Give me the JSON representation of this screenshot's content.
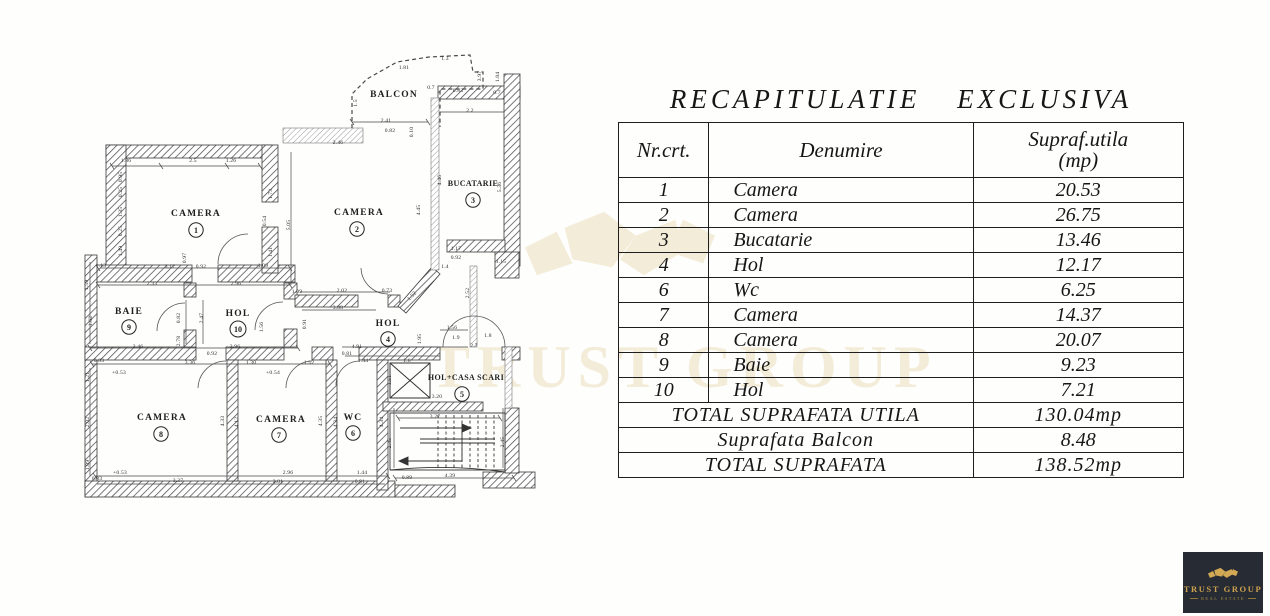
{
  "watermark": {
    "text": "TRUST GROUP",
    "color": "#f3ecd8"
  },
  "logo": {
    "name": "TRUST GROUP",
    "subtitle": "REAL ESTATE",
    "bg": "#272b34",
    "gold": "#cba14f"
  },
  "table": {
    "title": "RECAPITULATIE EXCLUSIVA",
    "columns": {
      "nr": "Nr.crt.",
      "den": "Denumire",
      "sup": "Supraf.utila",
      "sup_unit": "(mp)"
    },
    "rows": [
      [
        "1",
        "Camera",
        "20.53"
      ],
      [
        "2",
        "Camera",
        "26.75"
      ],
      [
        "3",
        "Bucatarie",
        "13.46"
      ],
      [
        "4",
        "Hol",
        "12.17"
      ],
      [
        "6",
        "Wc",
        "6.25"
      ],
      [
        "7",
        "Camera",
        "14.37"
      ],
      [
        "8",
        "Camera",
        "20.07"
      ],
      [
        "9",
        "Baie",
        "9.23"
      ],
      [
        "10",
        "Hol",
        "7.21"
      ]
    ],
    "totals": [
      {
        "label": "TOTAL SUPRAFATA  UTILA",
        "value": "130.04mp"
      },
      {
        "label": "Suprafata Balcon",
        "value": "8.48"
      },
      {
        "label": "TOTAL SUPRAFATA",
        "value": "138.52mp"
      }
    ]
  },
  "floorplan": {
    "rooms": [
      {
        "label": "CAMERA",
        "num": "1",
        "lx": 196,
        "ly": 216,
        "nx": 196,
        "ny": 230
      },
      {
        "label": "CAMERA",
        "num": "2",
        "lx": 359,
        "ly": 215,
        "nx": 357,
        "ny": 229
      },
      {
        "label": "BUCATARIE",
        "num": "3",
        "lx": 473,
        "ly": 186,
        "nx": 473,
        "ny": 200,
        "small": true
      },
      {
        "label": "BALCON",
        "lx": 394,
        "ly": 97
      },
      {
        "label": "BAIE",
        "num": "9",
        "lx": 129,
        "ly": 314,
        "nx": 129,
        "ny": 327
      },
      {
        "label": "HOL",
        "num": "10",
        "lx": 238,
        "ly": 316,
        "nx": 238,
        "ny": 329
      },
      {
        "label": "HOL",
        "num": "4",
        "lx": 388,
        "ly": 326,
        "nx": 388,
        "ny": 339
      },
      {
        "label": "CAMERA",
        "num": "8",
        "lx": 162,
        "ly": 420,
        "nx": 161,
        "ny": 434
      },
      {
        "label": "CAMERA",
        "num": "7",
        "lx": 281,
        "ly": 422,
        "nx": 279,
        "ny": 435
      },
      {
        "label": "WC",
        "num": "6",
        "lx": 353,
        "ly": 420,
        "nx": 353,
        "ny": 433
      },
      {
        "label": "HOL+CASA SCARI",
        "num": "5",
        "lx": 466,
        "ly": 380,
        "nx": 462,
        "ny": 394,
        "small": true
      }
    ],
    "dims": [
      [
        "1.86",
        126,
        162
      ],
      [
        "2.5",
        193,
        162
      ],
      [
        "1.26",
        231,
        162
      ],
      [
        "0.95",
        122,
        177,
        1
      ],
      [
        "0.25",
        122,
        192,
        1
      ],
      [
        "1.35",
        122,
        212,
        1
      ],
      [
        "0.25",
        122,
        231,
        1
      ],
      [
        "1.49",
        122,
        251,
        1
      ],
      [
        "0.97",
        186,
        258,
        1
      ],
      [
        "3.17",
        170,
        268
      ],
      [
        "0.92",
        201,
        268
      ],
      [
        "1.09",
        263,
        267
      ],
      [
        "1.13",
        101,
        267
      ],
      [
        "2.33",
        152,
        285
      ],
      [
        "2.96",
        236,
        285
      ],
      [
        "1.59",
        88,
        285,
        1
      ],
      [
        "1.73",
        272,
        194,
        1
      ],
      [
        "0.54",
        266,
        221,
        1
      ],
      [
        "1.41",
        272,
        252,
        1
      ],
      [
        "5.05",
        290,
        225,
        1
      ],
      [
        "2.46",
        338,
        144
      ],
      [
        "2.41",
        386,
        122
      ],
      [
        "0.82",
        390,
        132
      ],
      [
        "0.10",
        413,
        132,
        1
      ],
      [
        "1.81",
        404,
        69
      ],
      [
        "1.3",
        445,
        60
      ],
      [
        "0.7",
        431,
        89
      ],
      [
        "0.83",
        458,
        92
      ],
      [
        "0.7",
        497,
        94
      ],
      [
        "2.2",
        470,
        112
      ],
      [
        "1.5",
        357,
        103,
        1
      ],
      [
        "3.97",
        481,
        76,
        1
      ],
      [
        "1.84",
        499,
        77,
        1
      ],
      [
        "4.46",
        441,
        180,
        1
      ],
      [
        "4.45",
        420,
        210,
        1
      ],
      [
        "5.36",
        501,
        187,
        1
      ],
      [
        "1.17",
        456,
        250
      ],
      [
        "0.92",
        456,
        259
      ],
      [
        "1.4",
        445,
        268
      ],
      [
        "1.15",
        501,
        263
      ],
      [
        "2.52",
        469,
        293,
        1
      ],
      [
        "2.02",
        342,
        292
      ],
      [
        "0.73",
        387,
        292
      ],
      [
        "1.52",
        413,
        297,
        2
      ],
      [
        "3.88",
        338,
        309
      ],
      [
        "1.09",
        297,
        293
      ],
      [
        "1.62",
        92,
        321,
        1
      ],
      [
        "0.82",
        180,
        318,
        1
      ],
      [
        "2.47",
        203,
        318,
        1
      ],
      [
        "2.78",
        180,
        341,
        1
      ],
      [
        "1.56",
        263,
        327,
        1
      ],
      [
        "0.91",
        306,
        324,
        1
      ],
      [
        "3.46",
        138,
        348
      ],
      [
        "2.96",
        235,
        348
      ],
      [
        "0.92",
        212,
        355
      ],
      [
        "1.56",
        452,
        329
      ],
      [
        "1.9",
        456,
        339
      ],
      [
        "1.8",
        488,
        337
      ],
      [
        "2.7",
        474,
        347
      ],
      [
        "1.95",
        421,
        339,
        1
      ],
      [
        "4.91",
        357,
        348
      ],
      [
        "0.81",
        347,
        355
      ],
      [
        "1.44",
        363,
        362
      ],
      [
        "1.6",
        407,
        362
      ],
      [
        "1.51",
        391,
        380,
        1
      ],
      [
        "3.20",
        437,
        398
      ],
      [
        "0.83",
        99,
        362
      ],
      [
        "3.36",
        190,
        364
      ],
      [
        "1.30",
        251,
        364
      ],
      [
        "1.52",
        309,
        364
      ],
      [
        "+0.53",
        119,
        374
      ],
      [
        "+0.54",
        273,
        374
      ],
      [
        "1.21",
        89,
        377,
        1
      ],
      [
        "2.02",
        89,
        422,
        1
      ],
      [
        "1.09",
        89,
        465,
        1
      ],
      [
        "4.33",
        224,
        421,
        1
      ],
      [
        "4.12",
        238,
        422,
        1
      ],
      [
        "4.35",
        322,
        421,
        1
      ],
      [
        "4.34",
        337,
        422,
        1
      ],
      [
        "4.34",
        383,
        422,
        1
      ],
      [
        "0.83",
        97,
        480
      ],
      [
        "+0.53",
        120,
        474
      ],
      [
        "3.37",
        178,
        482
      ],
      [
        "2.96",
        288,
        474
      ],
      [
        "2.01",
        278,
        483
      ],
      [
        "1.44",
        362,
        474
      ],
      [
        "0.91",
        360,
        483
      ],
      [
        "3.27",
        435,
        418
      ],
      [
        "2.45",
        391,
        443,
        1
      ],
      [
        "2.45",
        504,
        442,
        1
      ],
      [
        "4.39",
        450,
        477
      ],
      [
        "0.89",
        407,
        479
      ]
    ]
  }
}
